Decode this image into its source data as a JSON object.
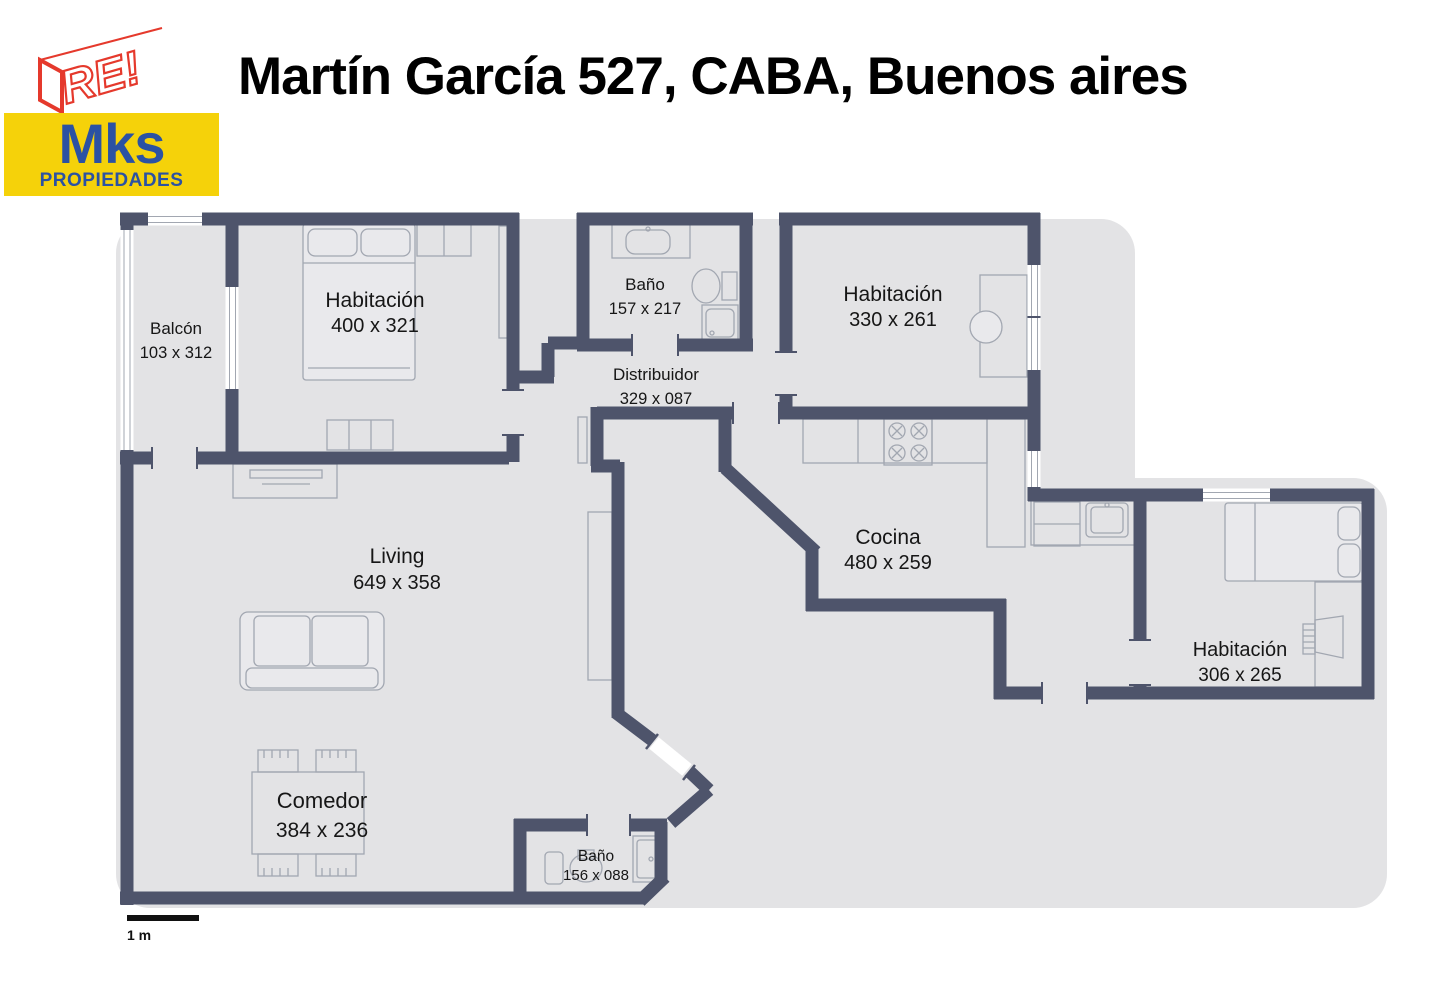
{
  "header": {
    "title": "Martín García 527, CABA, Buenos aires",
    "logo": {
      "text": "RE!"
    },
    "agency": {
      "name": "Mks",
      "subtitle": "PROPIEDADES"
    }
  },
  "plan": {
    "scale_label": "1 m",
    "rooms": {
      "balcon": {
        "name": "Balcón",
        "dims": "103 x 312"
      },
      "habitacion_1": {
        "name": "Habitación",
        "dims": "400 x 321"
      },
      "bano_1": {
        "name": "Baño",
        "dims": "157 x 217"
      },
      "distribuidor": {
        "name": "Distribuidor",
        "dims": "329 x 087"
      },
      "habitacion_2": {
        "name": "Habitación",
        "dims": "330 x 261"
      },
      "cocina": {
        "name": "Cocina",
        "dims": "480 x 259"
      },
      "living": {
        "name": "Living",
        "dims": "649 x 358"
      },
      "comedor": {
        "name": "Comedor",
        "dims": "384 x 236"
      },
      "habitacion_3": {
        "name": "Habitación",
        "dims": "306 x 265"
      },
      "bano_2": {
        "name": "Baño",
        "dims": "156 x 088"
      }
    }
  },
  "colors": {
    "wall": "#4E546B",
    "floor": "#E3E3E5",
    "logo_red": "#E5392C",
    "badge_yellow": "#F5D20A",
    "badge_blue": "#2B52A3"
  }
}
